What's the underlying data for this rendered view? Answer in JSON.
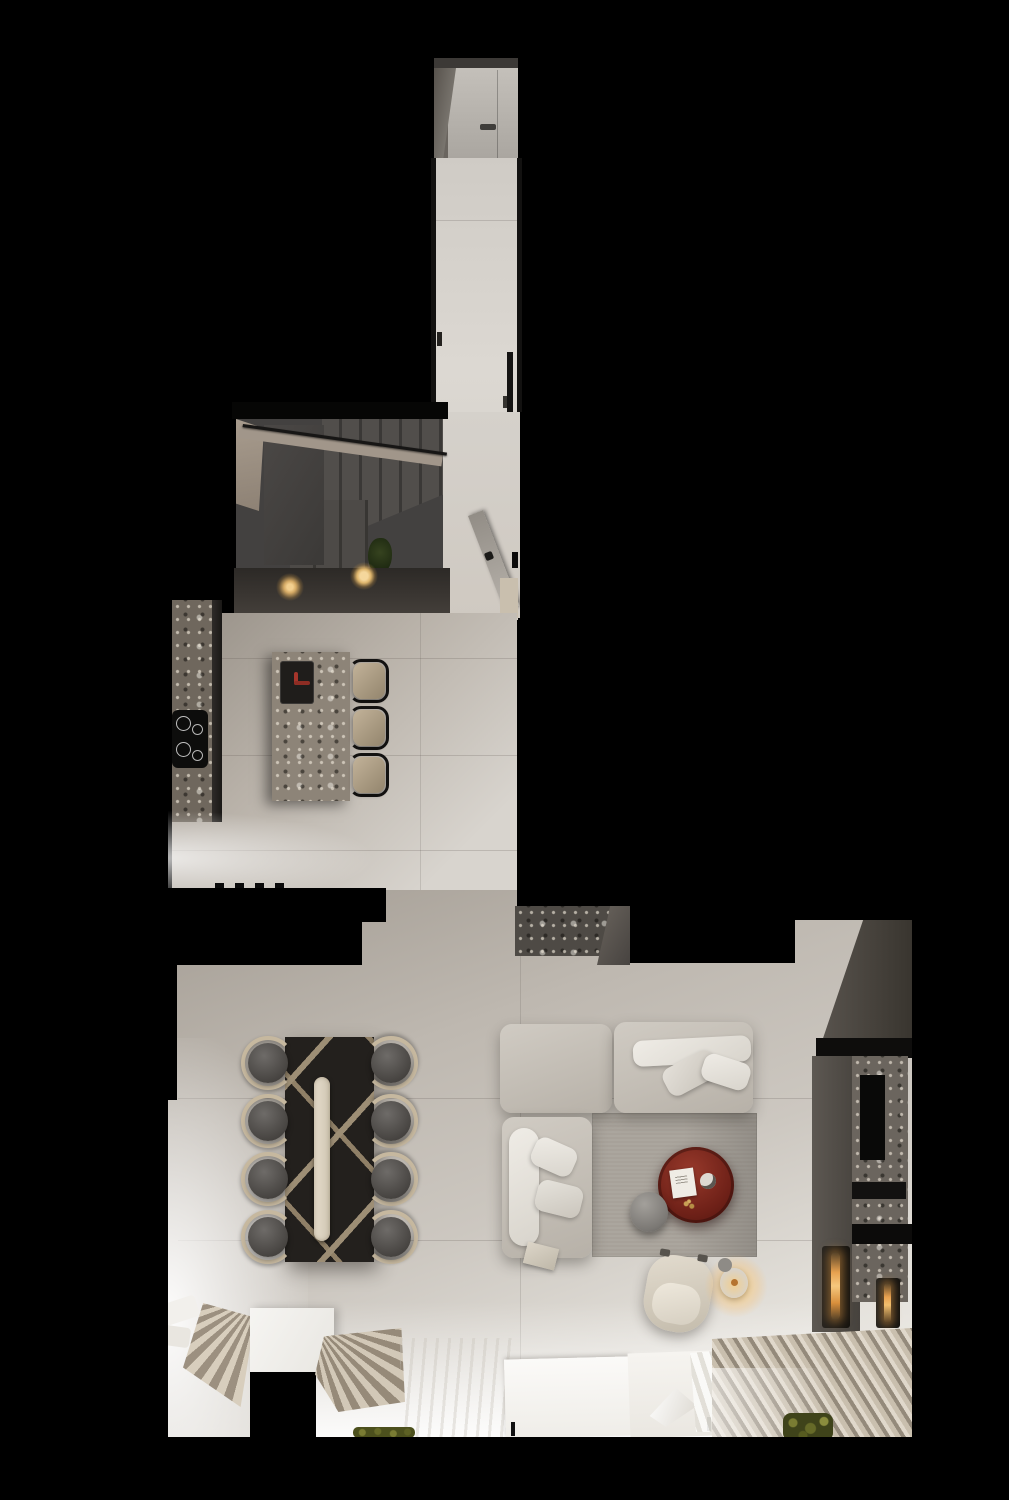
{
  "meta": {
    "scene_type": "top-down 3d interior render",
    "description": "open-plan apartment: entry corridor, winder staircase, kitchen with terrazzo island, dining table for eight, l-shaped sofa lounge with fireplace media wall"
  },
  "palette": {
    "background": "#000000",
    "floor_light": "#d7d3cd",
    "floor_warm": "#b2aba2",
    "floor_bright": "#f4f2ee",
    "wall_beige": "#a1968a",
    "stair_gray": "#454240",
    "counter_dark": "#36322e",
    "terrazzo_light": "#94897c",
    "terrazzo_dark": "#534e48",
    "cabinet_gray": "#55504b",
    "wall_dark_gray": "#47423e",
    "sofa_beige": "#c6c1b9",
    "cushion_white": "#ece9e3",
    "rug_gray": "#a7a199",
    "table_black": "#23201d",
    "inlay_tan": "#ab9a7f",
    "runner_cream": "#ded5c4",
    "chair_dark": "#4e4b49",
    "chair_wood": "#c6b89f",
    "accent_red": "#7a2a20",
    "faucet_red": "#a5352b",
    "flame_orange": "#e8a14f",
    "light_warm": "#f3cf8e",
    "curtain_beige": "#c9bfae",
    "curtain_shadow": "#948a7b",
    "sheer_white": "#f6f4f0",
    "plant_green": "#6a6d2f"
  },
  "scene": {
    "entry": [
      "entry-door",
      "door-handle",
      "upper-corridor-floor"
    ],
    "stairs": [
      "winder-staircase",
      "handrail",
      "stair-plant",
      "under-stair-counter",
      "under-cabinet-light",
      "under-cabinet-light"
    ],
    "kitchen": [
      "tall-terrazzo-counter",
      "cooktop",
      "kitchen-island",
      "island-sink",
      "red-faucet",
      "bar-stool",
      "bar-stool",
      "bar-stool",
      "white-counter",
      "kitchen-floor"
    ],
    "hall": [
      "open-door",
      "hall-floor",
      "stone-console"
    ],
    "dining": [
      "dining-table",
      "table-runner",
      "dining-chair x8",
      "fan-curtain",
      "fan-curtain"
    ],
    "lounge": [
      "sofa-module x3",
      "sofa-cushions",
      "area-rug",
      "red-coffee-table",
      "book",
      "cup",
      "side-pouf",
      "armchair",
      "candle-lamp",
      "floor-tray"
    ],
    "media_wall": [
      "dark-wall",
      "media-cabinet",
      "terrazzo-fireplace-wall",
      "tv-recess",
      "fireplace-burner",
      "fireplace-burner"
    ],
    "window_zone": [
      "window-sill-panels",
      "sheer-curtain",
      "pleated-curtain",
      "planter-greens",
      "planter-greens"
    ]
  }
}
